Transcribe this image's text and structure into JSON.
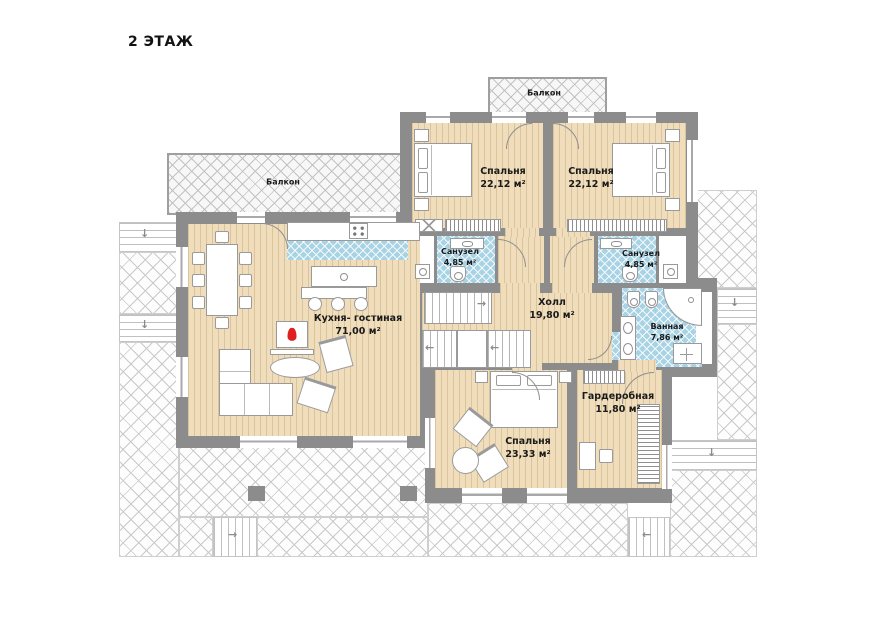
{
  "title": "2 ЭТАЖ",
  "rooms": {
    "balcony_top": {
      "name": "Балкон"
    },
    "bedroom1": {
      "name": "Спальня",
      "area": "22,12 м²"
    },
    "bedroom2": {
      "name": "Спальня",
      "area": "22,12 м²"
    },
    "sanuzel1": {
      "name": "Санузел",
      "area": "4,85 м²"
    },
    "sanuzel2": {
      "name": "Санузел",
      "area": "4,85 м²"
    },
    "hall": {
      "name": "Холл",
      "area": "19,80 м²"
    },
    "bathroom": {
      "name": "Ванная",
      "area": "7,86 м²"
    },
    "kitchen_living": {
      "name": "Кухня- гостиная",
      "area": "71,00 м²"
    },
    "balcony_left": {
      "name": "Балкон"
    },
    "bedroom3": {
      "name": "Спальня",
      "area": "23,33 м²"
    },
    "wardrobe": {
      "name": "Гардеробная",
      "area": "11,80 м²"
    }
  },
  "arrows": {
    "down": "↓",
    "left": "←",
    "right": "→"
  },
  "colors": {
    "wall": "#8c8c8c",
    "floor_wood": "#efddbb",
    "tile_blue": "#a8d3e4",
    "flame": "#e02020"
  }
}
